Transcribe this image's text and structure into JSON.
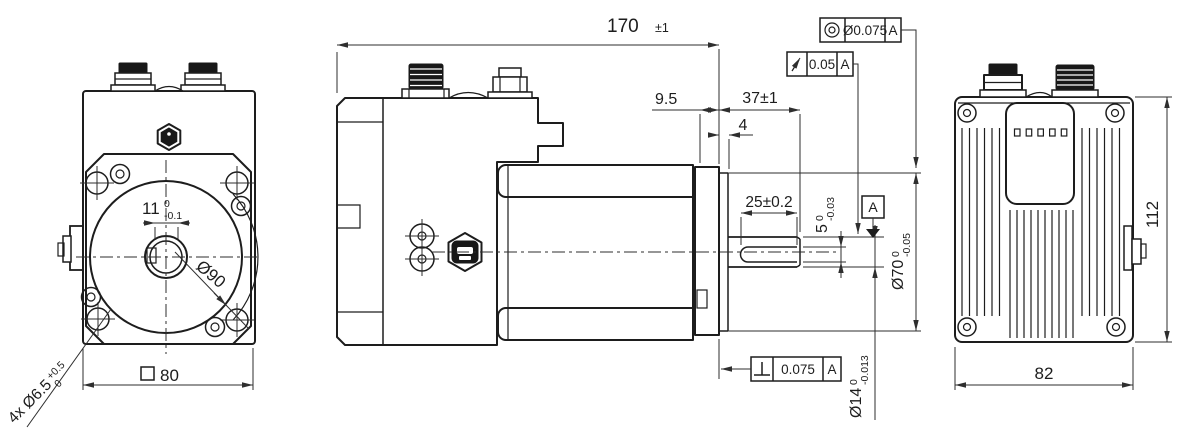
{
  "colors": {
    "line": "#1d1d1d",
    "dimension_line": "#2e2e2e",
    "background": "#ffffff",
    "dark_fill": "#181818"
  },
  "front": {
    "key_width": {
      "value": "11",
      "upper": "0",
      "lower": "-0.1"
    },
    "pilot_diameter": "Ø90",
    "flange_square": {
      "symbol": "square",
      "value": "80"
    },
    "mounting_holes": {
      "value": "4x Ø6.5",
      "upper": "+0.5",
      "lower": "0"
    }
  },
  "side": {
    "overall_length": {
      "value": "170",
      "tolerance": "±1"
    },
    "flange_offset": "9.5",
    "shaft_length": "37±1",
    "pilot_height": "4",
    "keyway_length": "25±0.2",
    "keyway_height": {
      "value": "5",
      "upper": "0",
      "lower": "-0.03"
    },
    "pilot_fit": {
      "value": "Ø70",
      "upper": "0",
      "lower": "-0.05"
    },
    "shaft_diameter": {
      "value": "Ø14",
      "upper": "0",
      "lower": "-0.013"
    },
    "datum": "A"
  },
  "frames": {
    "concentricity": {
      "symbol": "concentricity-icon",
      "value": "Ø0.075",
      "datum": "A"
    },
    "runout": {
      "symbol": "circular-runout-icon",
      "value": "0.05",
      "datum": "A"
    },
    "perpendicularity": {
      "symbol": "perpendicularity-icon",
      "value": "0.075",
      "datum": "A"
    }
  },
  "back": {
    "height": "112",
    "width": "82",
    "led_indicators": 5
  }
}
